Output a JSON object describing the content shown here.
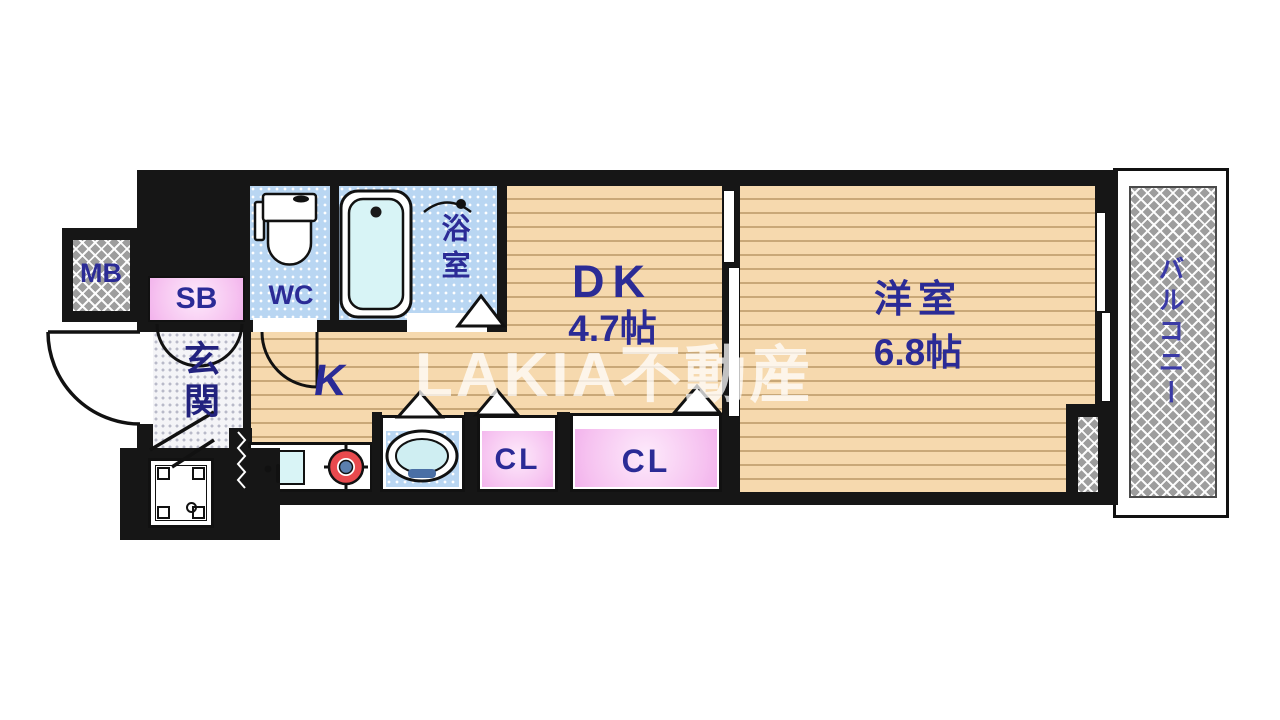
{
  "floorplan": {
    "watermark": "LAKIA不動産",
    "rooms": {
      "mb": {
        "label": "MB"
      },
      "sb": {
        "label": "SB"
      },
      "genkan": {
        "label": "玄関"
      },
      "wc": {
        "label": "WC"
      },
      "bath": {
        "label": "浴室"
      },
      "kitchen": {
        "label": "K"
      },
      "dk": {
        "label": "DK",
        "size": "4.7帖"
      },
      "western_room": {
        "label": "洋室",
        "size": "6.8帖"
      },
      "closet1": {
        "label": "CL"
      },
      "closet2": {
        "label": "CL"
      },
      "balcony": {
        "label": "バルコニー"
      }
    },
    "colors": {
      "wall": "#161616",
      "wood_floor": "#f6d9ae",
      "wet_area_blue": "#b9d6f2",
      "closet_pink": "#f6c2f0",
      "label_blue": "#2b2b96",
      "balcony_gray": "#9d9d9d"
    }
  }
}
